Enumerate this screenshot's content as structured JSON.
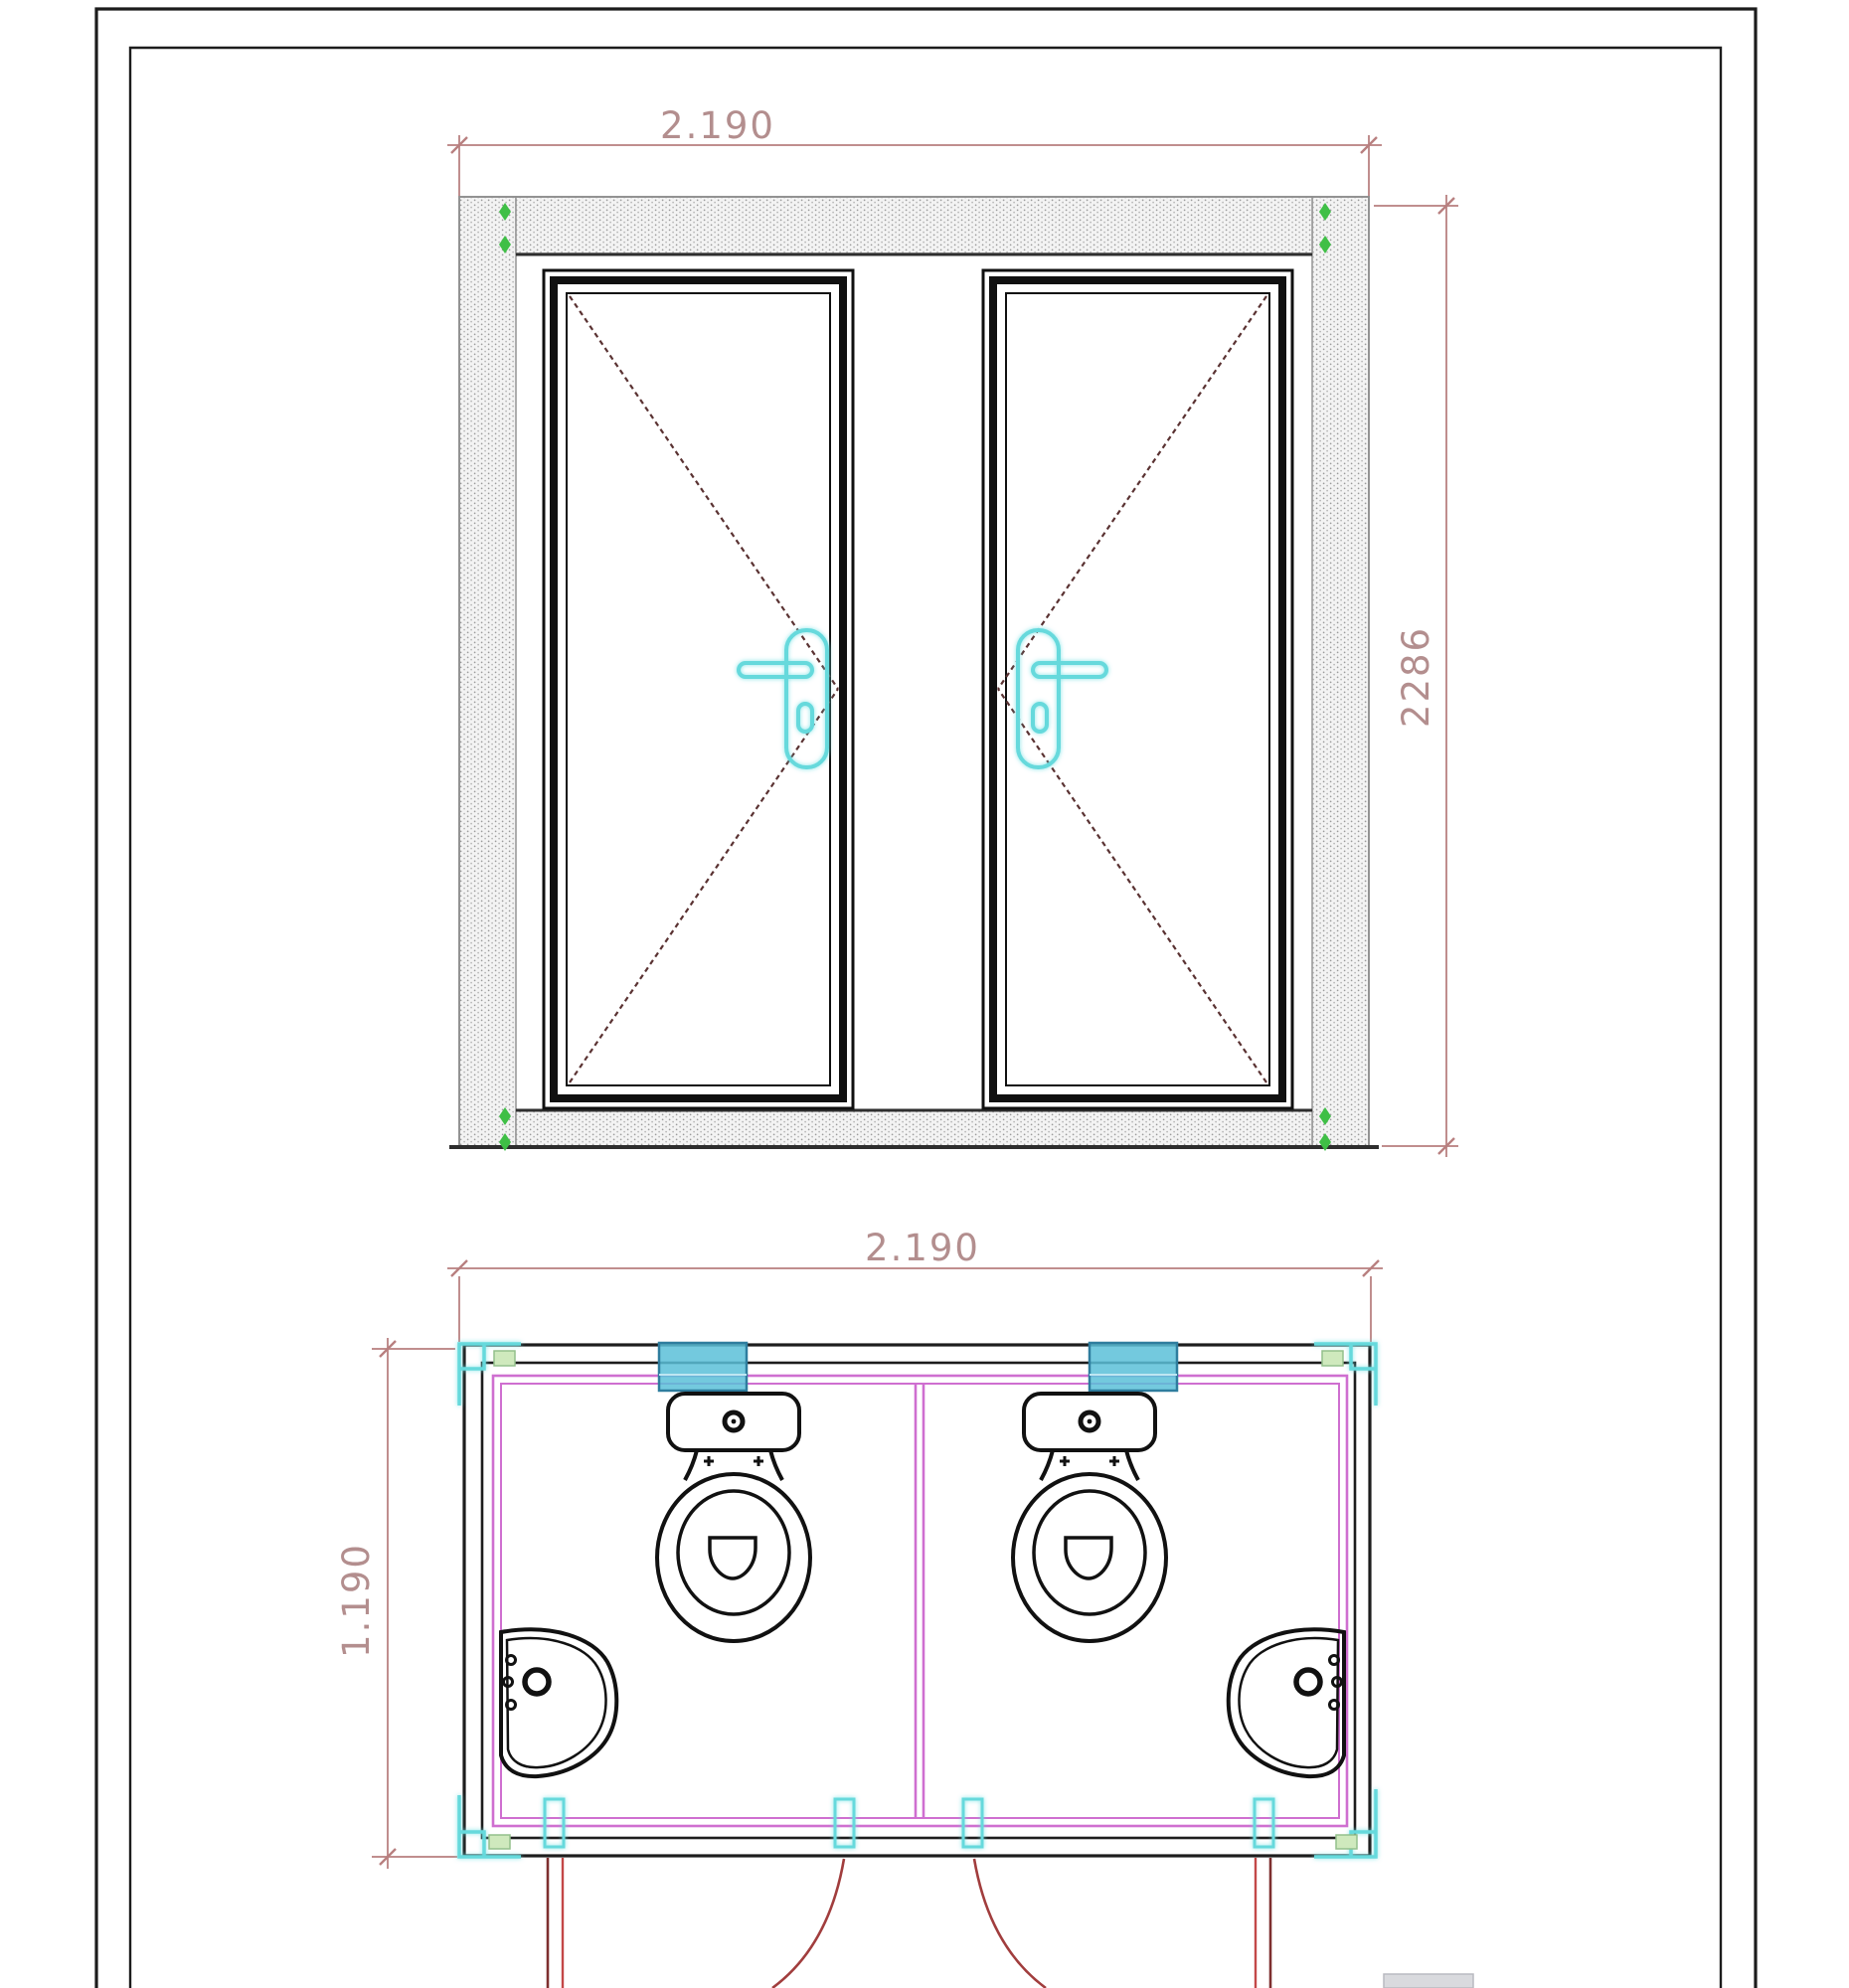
{
  "document": {
    "kind": "CAD technical drawing",
    "subject": "Double sanitary cabin with two doors: front elevation and floor plan",
    "views": [
      "front-elevation",
      "floor-plan"
    ]
  },
  "elevation": {
    "width_label": "2.190",
    "height_label": "2286",
    "door_count": 2,
    "parts": [
      "hatched-frame",
      "left-door-panel",
      "right-door-panel",
      "door-handles",
      "corner-markers"
    ]
  },
  "plan": {
    "width_label": "2.190",
    "depth_label": "1.190",
    "fixtures": [
      "toilet-left",
      "toilet-right",
      "washbasin-left",
      "washbasin-right"
    ],
    "features": [
      "center-partition-wall",
      "two-outward-swinging-doors",
      "wall-hinge-blocks",
      "corner-brackets"
    ]
  },
  "colors": {
    "dimension": "#c08e8e",
    "dashed_door_diagonal": "#5a3232",
    "handle_cyan": "#66d9dc",
    "marker_green": "#3fbf46",
    "inner_wall_magenta": "#cf6fd0",
    "hinge_block_teal": "#4fb3d4",
    "door_swing_red": "#a13d3d",
    "outline_black": "#1d1d1d"
  }
}
